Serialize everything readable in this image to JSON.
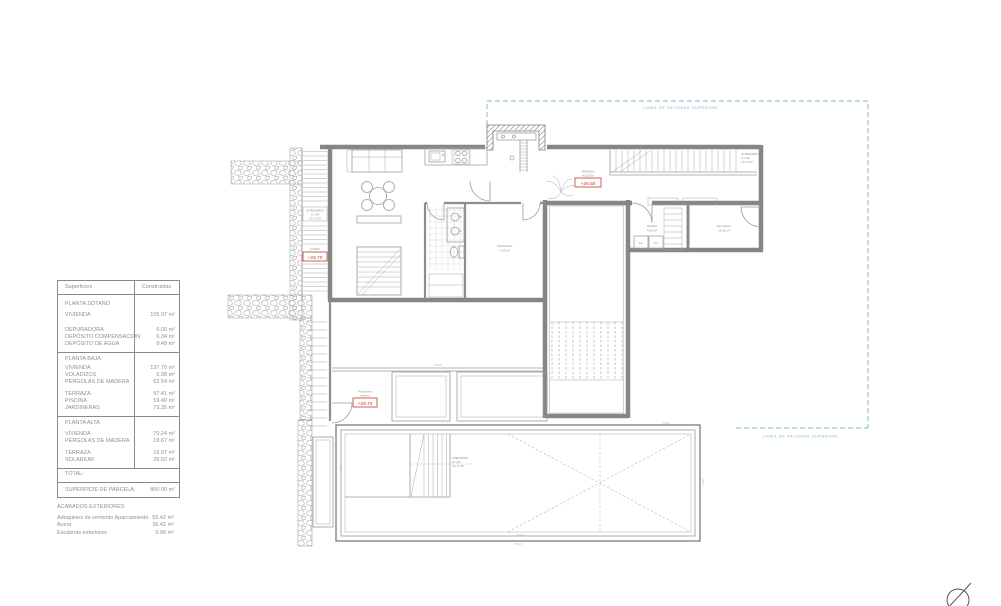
{
  "table": {
    "col_surface": "Superficies",
    "col_built": "Construidas",
    "rows": [
      {
        "label": "PLANTA SÓTANO",
        "value": ""
      },
      {
        "label": "VIVIENDA",
        "value": "105.97 m²"
      },
      {
        "label": "DEPURADORA",
        "value": "6.00 m²"
      },
      {
        "label": "DEPÓSITO COMPENSACIÓN",
        "value": "6.34 m²"
      },
      {
        "label": "DEPÓSITO DE AGUA",
        "value": "9.48 m²"
      },
      {
        "label": "PLANTA BAJA",
        "value": ""
      },
      {
        "label": "VIVIENDA",
        "value": "137.70 m²"
      },
      {
        "label": "VOLADIZOS",
        "value": "5.98 m²"
      },
      {
        "label": "PÉRGOLAS DE MADERA",
        "value": "62.54 m²"
      },
      {
        "label": "TERRAZA",
        "value": "97.41 m²"
      },
      {
        "label": "PISCINA",
        "value": "59.40 m²"
      },
      {
        "label": "JARDINERAS",
        "value": "73.35 m²"
      },
      {
        "label": "PLANTA ALTA",
        "value": ""
      },
      {
        "label": "VIVIENDA",
        "value": "70.24 m²"
      },
      {
        "label": "PÉRGOLAS DE MADERA",
        "value": "19.67 m²"
      },
      {
        "label": "TERRAZA",
        "value": "16.97 m²"
      },
      {
        "label": "SOLARIUM",
        "value": "25.02 m²"
      },
      {
        "label": "TOTAL:",
        "value": ""
      },
      {
        "label": "SUPERFICIE DE PARCELA:",
        "value": "800.00 m²"
      }
    ]
  },
  "exteriors": {
    "title": "ACABADOS EXTERIORES",
    "items": [
      {
        "label": "Adoquines de cemento Aparcamiento",
        "value": "55.42 m²"
      },
      {
        "label": "Acera",
        "value": "36.42 m²"
      },
      {
        "label": "Escaleras exteriores",
        "value": "9.90 m²"
      }
    ]
  },
  "plan": {
    "setback_top": "LINEA DE FACHADA SUPERIOR",
    "setback_bottom": "LINEA DE FACHADA SUPERIOR",
    "levels": {
      "hall": "+26.50",
      "hall_cap1": "TERRAZA",
      "hall_cap2": "ACCESO",
      "acera": "+29.70",
      "acera_cap": "ACERA",
      "terraza": "+29.70",
      "terraza_cap1": "Pavimento",
      "terraza_cap2": "exterior"
    },
    "rooms": {
      "dormitorio": "Dormitorio",
      "dormitorio_area": "13.19 m²",
      "vestidor": "Vestidor",
      "vestidor_area": "4.20 m²",
      "hall": "Distribuidor",
      "hall_area": "8.10 m²",
      "arm1": "Arm",
      "arm2": "Arm"
    },
    "stair_notes": {
      "left1": "18 PELDAÑOS",
      "left2": "H: 0.30",
      "left3": "CH: 0.175",
      "right1": "15 PELDAÑOS",
      "right2": "H: 0.28",
      "right3": "CH: 0.175",
      "deck1": "9 PELDAÑOS",
      "deck2": "H: 0.30",
      "deck3": "CH: 0.175"
    },
    "dims": {
      "d1": "15.38",
      "d2": "24.30",
      "d3": "9.05",
      "d4": "5.40",
      "d5": "3.20",
      "d6": "25.10"
    }
  },
  "colors": {
    "red": "#c0392b",
    "cyan": "#7ab8c4",
    "wall": "#868686",
    "text": "#8f8f8f"
  }
}
